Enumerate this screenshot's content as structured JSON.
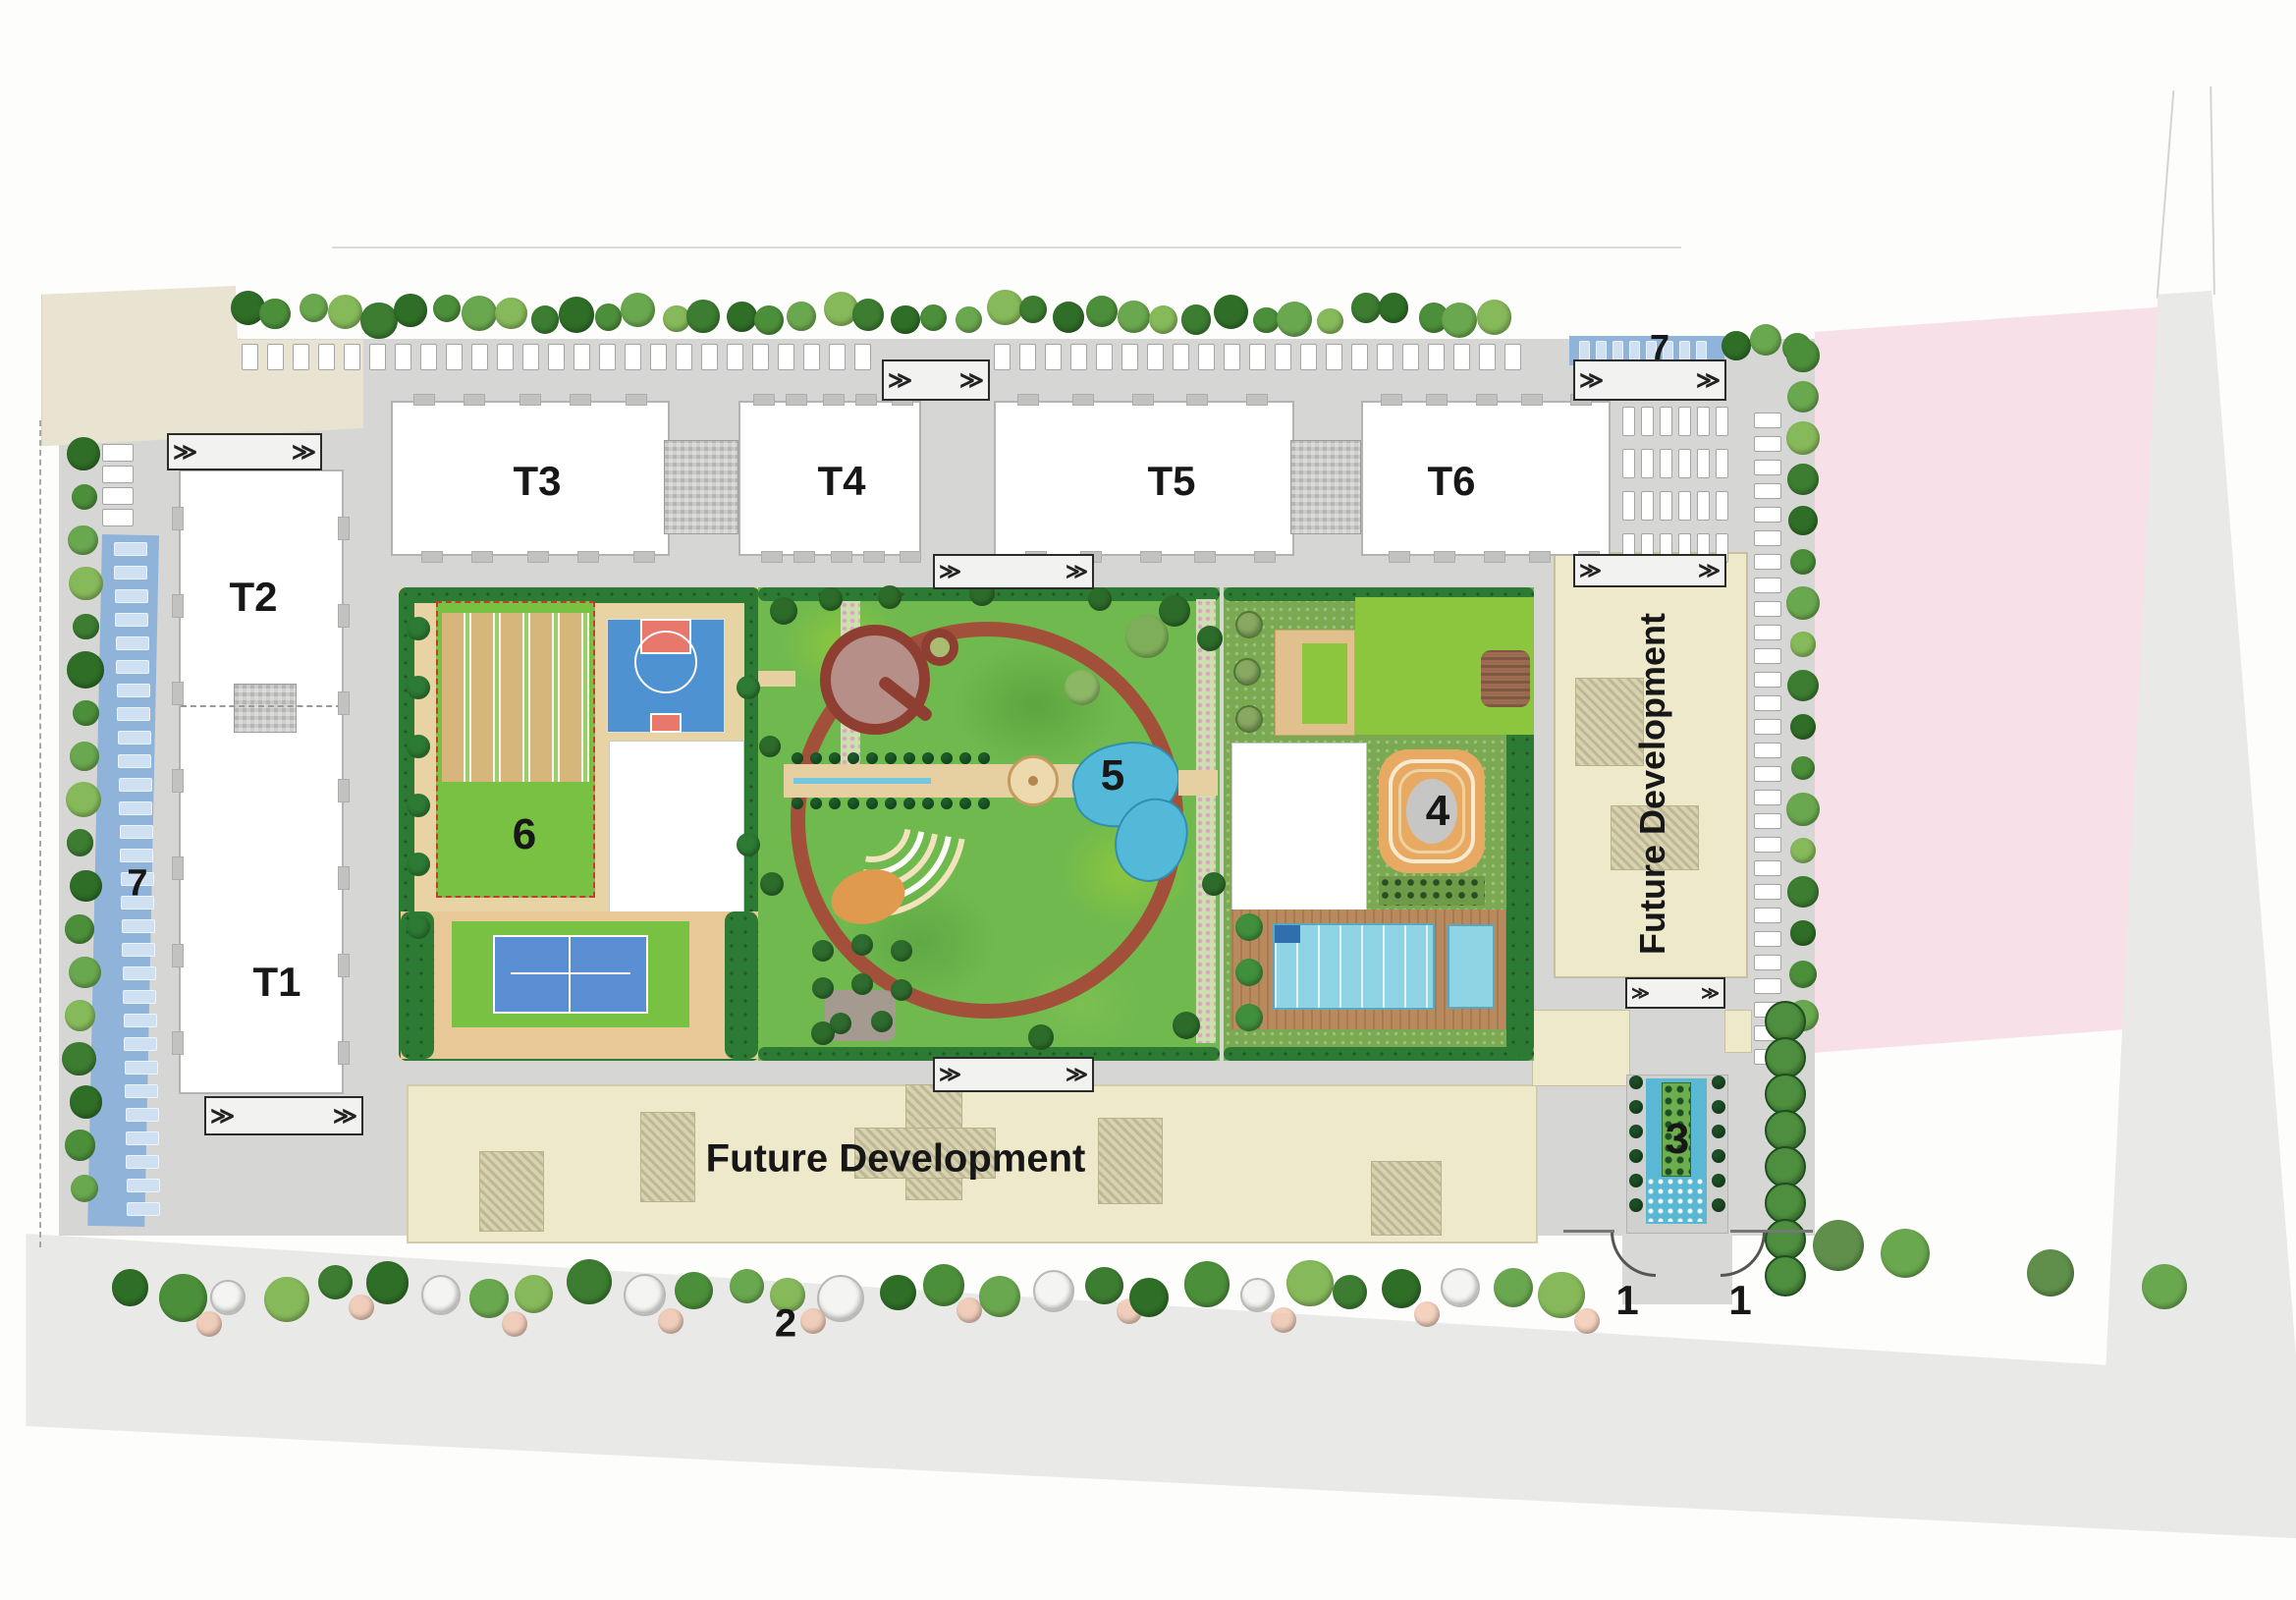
{
  "site_plan": {
    "towers": {
      "t1": "T1",
      "t2": "T2",
      "t3": "T3",
      "t4": "T4",
      "t5": "T5",
      "t6": "T6"
    },
    "markers": {
      "m1_left": "1",
      "m1_right": "1",
      "m2": "2",
      "m3": "3",
      "m4": "4",
      "m5": "5",
      "m6": "6",
      "m7_left": "7",
      "m7_top_right": "7"
    },
    "areas": {
      "future_dev_bottom": "Future Development",
      "future_dev_right": "Future Development"
    },
    "colors": {
      "site_road": "#d6d6d4",
      "road_outer": "#e9e9e7",
      "sand": "#e9e3d2",
      "adjacent_plot_pink": "#f8e0e8",
      "future_dev": "#efe9cb",
      "future_dev_core": "#d8d2ae",
      "parking_strip_blue": "#8fb3d9",
      "hedge": "#2c7a33",
      "lawn": "#8cc63f",
      "garden_green": "#6fb94e",
      "path_tan": "#e6cfa0",
      "circle_path": "#a3503a",
      "water": "#54b8d8",
      "pool_water": "#8fd4e4",
      "court_blue": "#4f92d2",
      "court_red": "#e8786c",
      "court_green": "#79c143",
      "cricket_tan": "#d7b67c",
      "deck_wood": "#b98a5d",
      "tower_white": "#ffffff",
      "label_black": "#171717"
    }
  }
}
